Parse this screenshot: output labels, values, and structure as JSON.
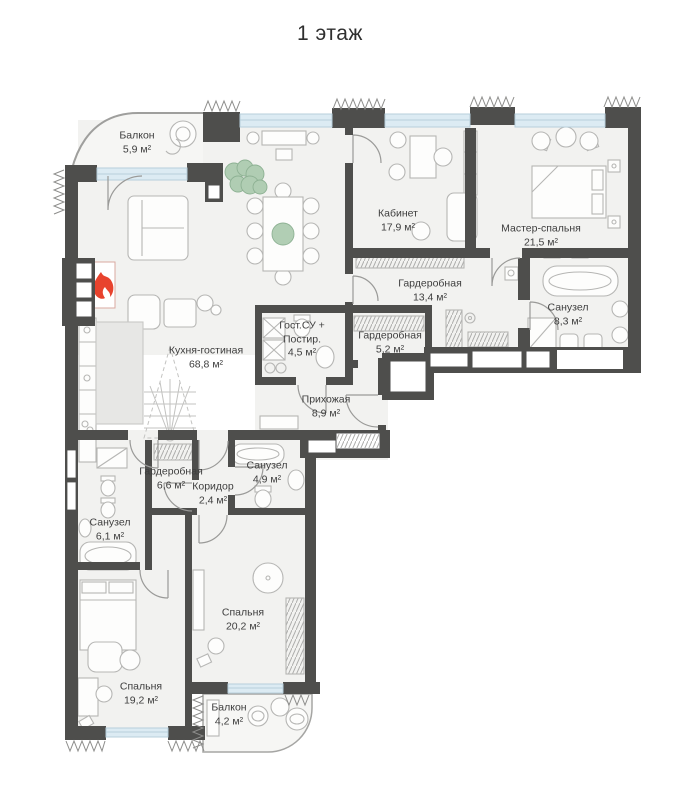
{
  "title": "1 этаж",
  "plan": {
    "rooms": [
      {
        "id": "balcony-top",
        "name": "Балкон",
        "area": "5,9 м²"
      },
      {
        "id": "office",
        "name": "Кабинет",
        "area": "17,9 м²"
      },
      {
        "id": "master-bedroom",
        "name": "Мастер-спальня",
        "area": "21,5 м²"
      },
      {
        "id": "wardrobe-master",
        "name": "Гардеробная",
        "area": "13,4 м²"
      },
      {
        "id": "bathroom-master",
        "name": "Санузел",
        "area": "8,3 м²"
      },
      {
        "id": "kitchen-living",
        "name": "Кухня-гостиная",
        "area": "68,8 м²"
      },
      {
        "id": "guest-wc-laundry",
        "name": "Гост.СУ + Постир.",
        "area": "4,5 м²"
      },
      {
        "id": "wardrobe-small",
        "name": "Гардеробная",
        "area": "5,2 м²"
      },
      {
        "id": "hallway",
        "name": "Прихожая",
        "area": "8,9 м²"
      },
      {
        "id": "wardrobe-bedroom",
        "name": "Гардеробная",
        "area": "6,6 м²"
      },
      {
        "id": "corridor",
        "name": "Коридор",
        "area": "2,4 м²"
      },
      {
        "id": "bathroom-2",
        "name": "Санузел",
        "area": "4,9 м²"
      },
      {
        "id": "bathroom-3",
        "name": "Санузел",
        "area": "6,1 м²"
      },
      {
        "id": "bedroom-2",
        "name": "Спальня",
        "area": "20,2 м²"
      },
      {
        "id": "bedroom-3",
        "name": "Спальня",
        "area": "19,2 м²"
      },
      {
        "id": "balcony-bottom",
        "name": "Балкон",
        "area": "4,2 м²"
      }
    ],
    "colors": {
      "wall": "#4e4e4c",
      "floor": "#f2f2f0",
      "window": "#dcebf3",
      "furniture_line": "#b6b6b4",
      "flame": "#e8432e",
      "plant": "#a9c9ad",
      "label_text": "#3e3e3e"
    }
  }
}
